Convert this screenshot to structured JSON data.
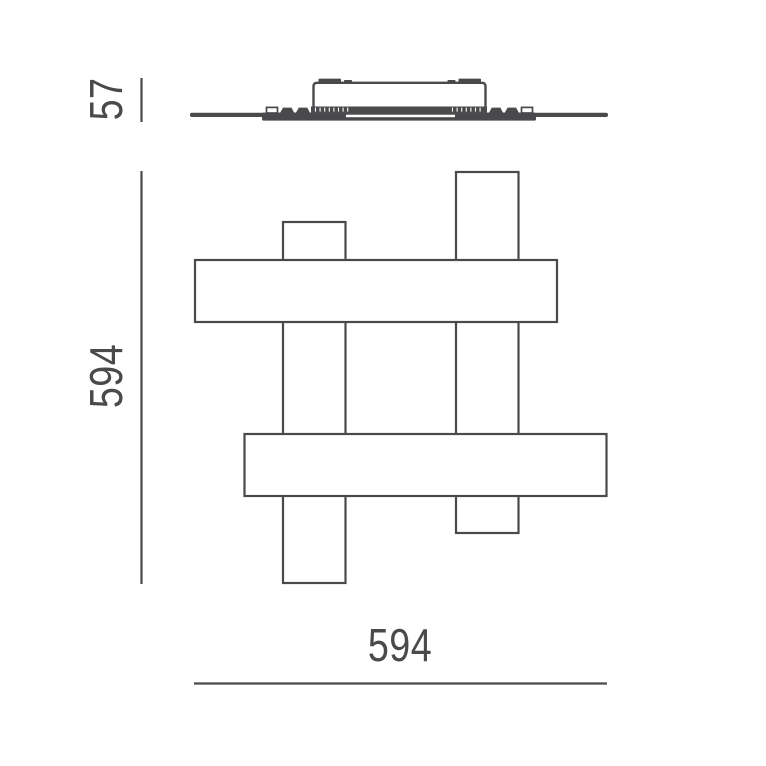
{
  "colors": {
    "background": "#ffffff",
    "line": "#4a4a4d"
  },
  "views": {
    "side_profile": {
      "name": "side-profile-view",
      "height_dimension": {
        "value": "57"
      }
    },
    "front": {
      "name": "front-view",
      "height_dimension": {
        "value": "594"
      },
      "width_dimension": {
        "value": "594"
      }
    }
  }
}
